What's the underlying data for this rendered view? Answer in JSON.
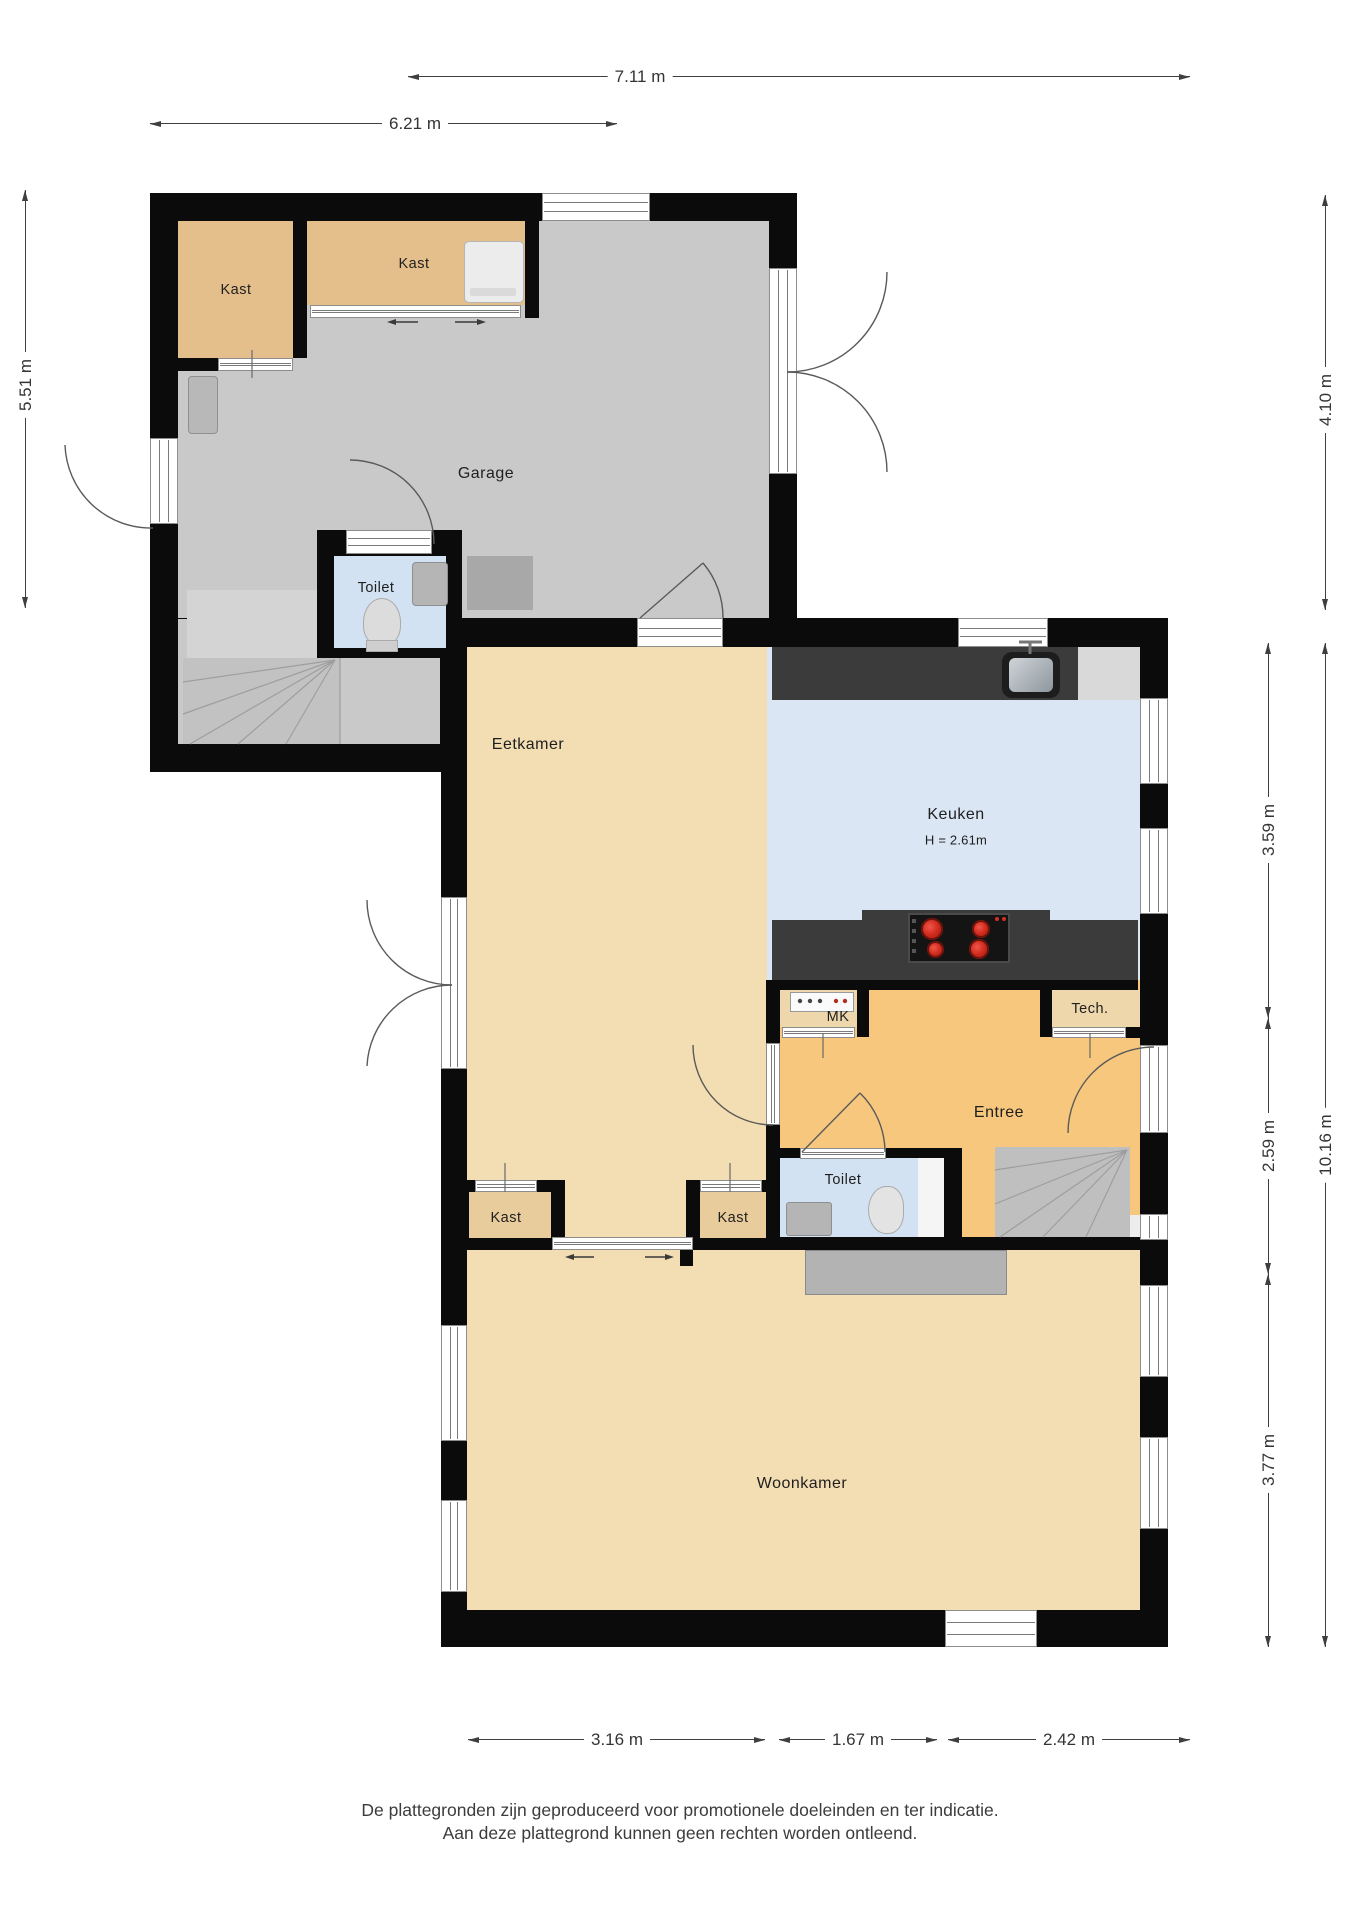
{
  "title": "Plattegrond begane grond",
  "rooms": {
    "garage": "Garage",
    "kast": "Kast",
    "toilet": "Toilet",
    "eetkamer": "Eetkamer",
    "keuken": "Keuken",
    "keuken_height": "H = 2.61m",
    "mk": "MK",
    "tech": "Tech.",
    "entree": "Entree",
    "woonkamer": "Woonkamer"
  },
  "dimensions": {
    "top_width": "7.11 m",
    "garage_width": "6.21 m",
    "garage_height": "5.51 m",
    "right_upper": "4.10 m",
    "keuken_depth": "3.59 m",
    "entree_depth": "2.59 m",
    "woonkamer_depth": "3.77 m",
    "total_depth": "10.16 m",
    "bottom_left": "3.16 m",
    "bottom_middle": "1.67 m",
    "bottom_right": "2.42 m"
  },
  "disclaimer": {
    "line1": "De plattegronden zijn geproduceerd voor promotionele doeleinden en ter indicatie.",
    "line2": "Aan deze plattegrond kunnen geen rechten worden ontleend."
  },
  "fixtures": {
    "stove": "4-burner-cooktop",
    "kitchen_sink": "kitchen-sink",
    "toilet_bowl": "toilet-bowl",
    "hand_sink": "hand-basin",
    "washer": "washing-machine",
    "stairs": "winder-stairs",
    "meter_cabinet": "meter-cabinet",
    "radiator": "radiator",
    "workbench": "workbench",
    "sideboard": "sideboard"
  },
  "colors": {
    "wall": "#0b0b0b",
    "garage_floor": "#c9c9c9",
    "closet_floor": "#e4bf8c",
    "toilet_floor": "#d3e2f2",
    "living_floor": "#f2deb2",
    "keuken_floor": "#dae6f4",
    "entree_floor": "#f6c77d",
    "mk_tech_floor": "#eed7ab",
    "counter": "#3b3b3b",
    "burner_red": "#cf2a1c",
    "dim_text": "#343434"
  }
}
